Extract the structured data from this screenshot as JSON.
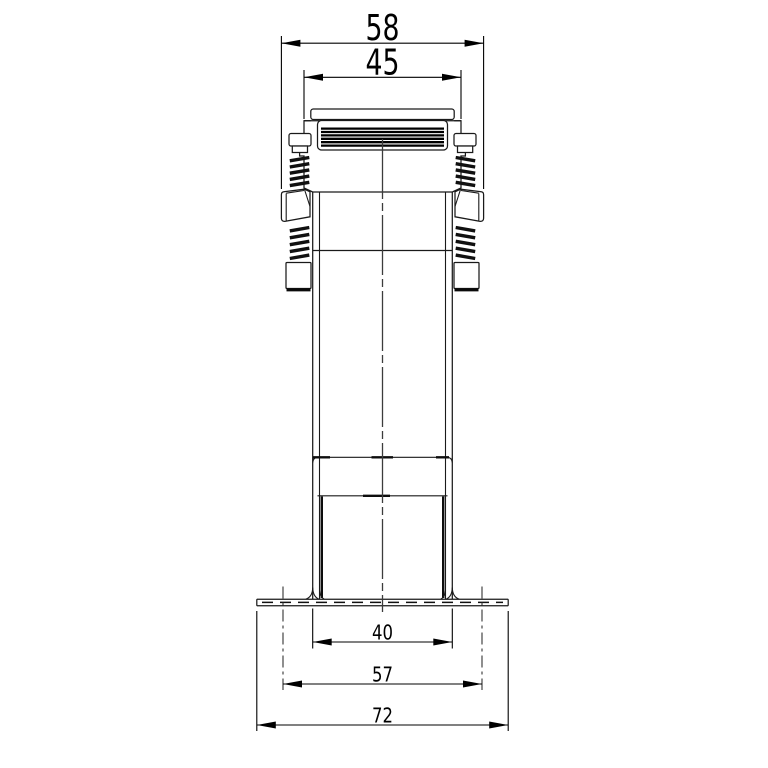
{
  "page": {
    "background_color": "#ffffff",
    "line_color": "#1a1a1a"
  },
  "drawing": {
    "view": "front orthographic view of clamp-mounted transformer body",
    "dimensions": {
      "top_outer_width": {
        "label": "58"
      },
      "top_body_width": {
        "label": "45"
      },
      "base_column_width": {
        "label": "40"
      },
      "mounting_centers_width": {
        "label": "57"
      },
      "flange_overall_width": {
        "label": "72"
      }
    }
  }
}
